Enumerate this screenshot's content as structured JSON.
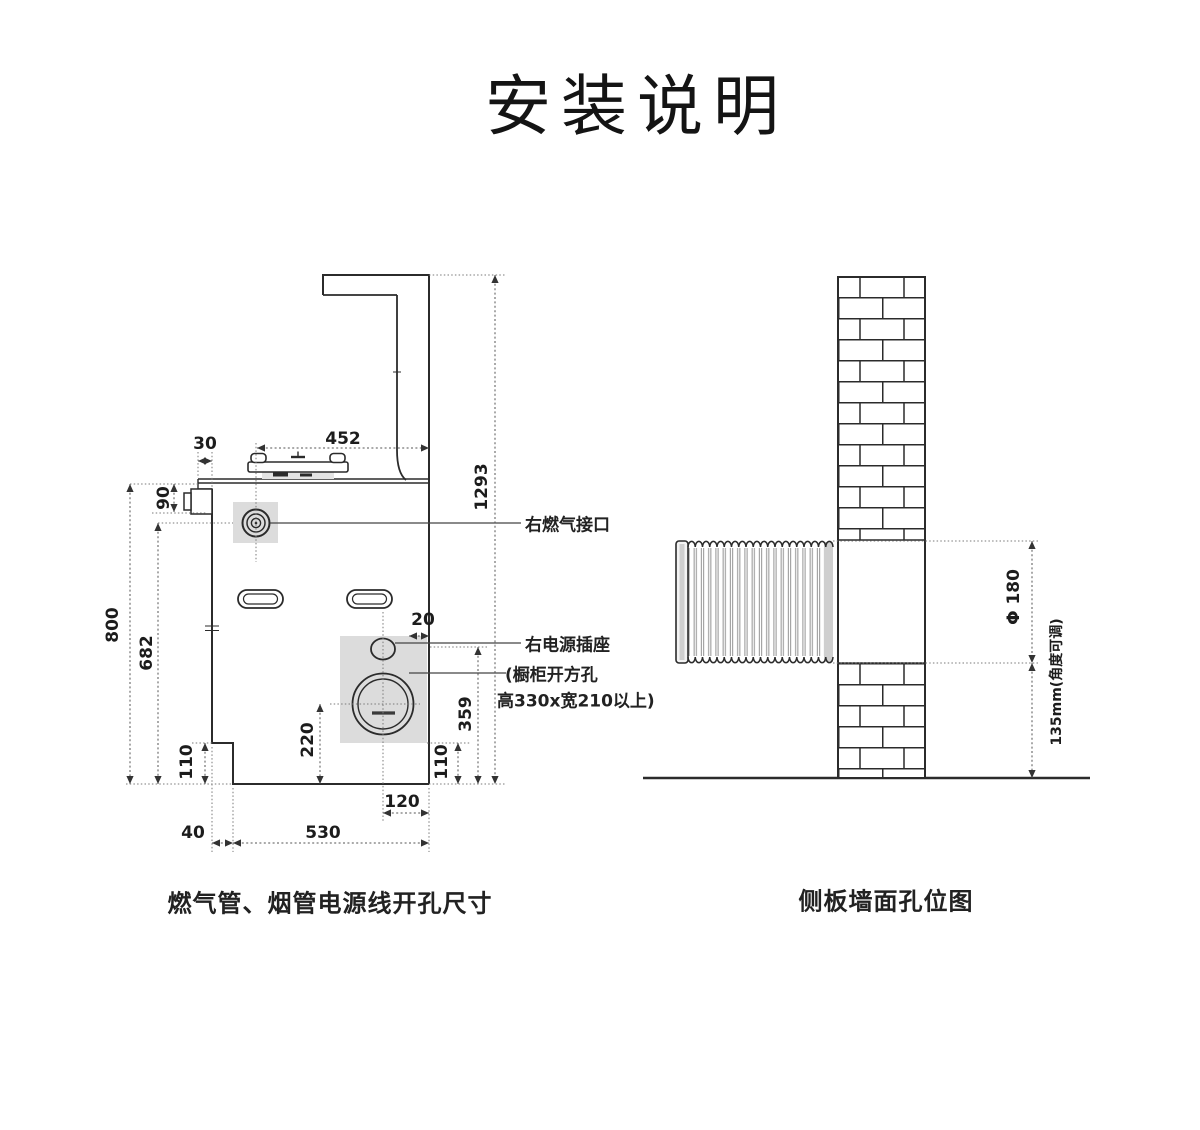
{
  "title": "安装说明",
  "left_diagram": {
    "caption": "燃气管、烟管电源线开孔尺寸",
    "labels": {
      "gas_port": "右燃气接口",
      "power_socket": "右电源插座",
      "cabinet_hole_line1": "(橱柜开方孔",
      "cabinet_hole_line2": "高330x宽210以上)"
    },
    "dimensions": {
      "top_width": "452",
      "left_offset": "30",
      "top_section_height": "90",
      "total_height": "800",
      "lower_height": "682",
      "bottom_left_height": "110",
      "overall_height": "1293",
      "socket_offset": "20",
      "circle_to_bottom": "220",
      "socket_to_bottom": "359",
      "bottom_right_height": "110",
      "circle_to_right": "120",
      "left_step_width": "40",
      "bottom_width": "530"
    }
  },
  "right_diagram": {
    "caption": "侧板墙面孔位图",
    "dimensions": {
      "pipe_diameter": "Φ 180",
      "pipe_height_note": "135mm(角度可调)"
    }
  }
}
